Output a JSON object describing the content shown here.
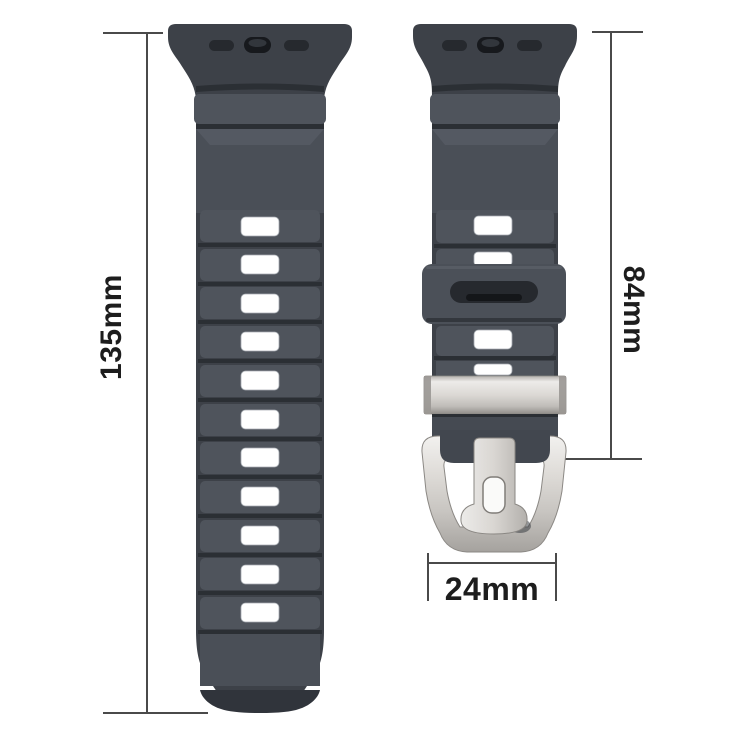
{
  "image": {
    "type": "product-dimension-diagram",
    "subject": "rubber sport watch band with silver pin buckle, two straps with size measurements"
  },
  "labels": {
    "long_strap_length": "135mm",
    "short_strap_length": "84mm",
    "band_width": "24mm"
  },
  "parts": {
    "long_strap": "strap with adjustment holes",
    "short_strap": "strap with buckle",
    "rubber_keeper": "rubber keeper loop",
    "metal_keeper": "metal keeper band",
    "buckle": "silver pin buckle with tang"
  },
  "colors": {
    "background": "#ffffff",
    "strap": "#4a4f57",
    "strap_shadow": "#3d4148",
    "groove": "#2b2f34",
    "hole": "#ffffff",
    "metal_light": "#f0efed",
    "metal_mid": "#cac7c3",
    "metal_dark": "#a09d99",
    "dimension_line": "#4a4a4a",
    "label_text": "#1d1d1d"
  }
}
